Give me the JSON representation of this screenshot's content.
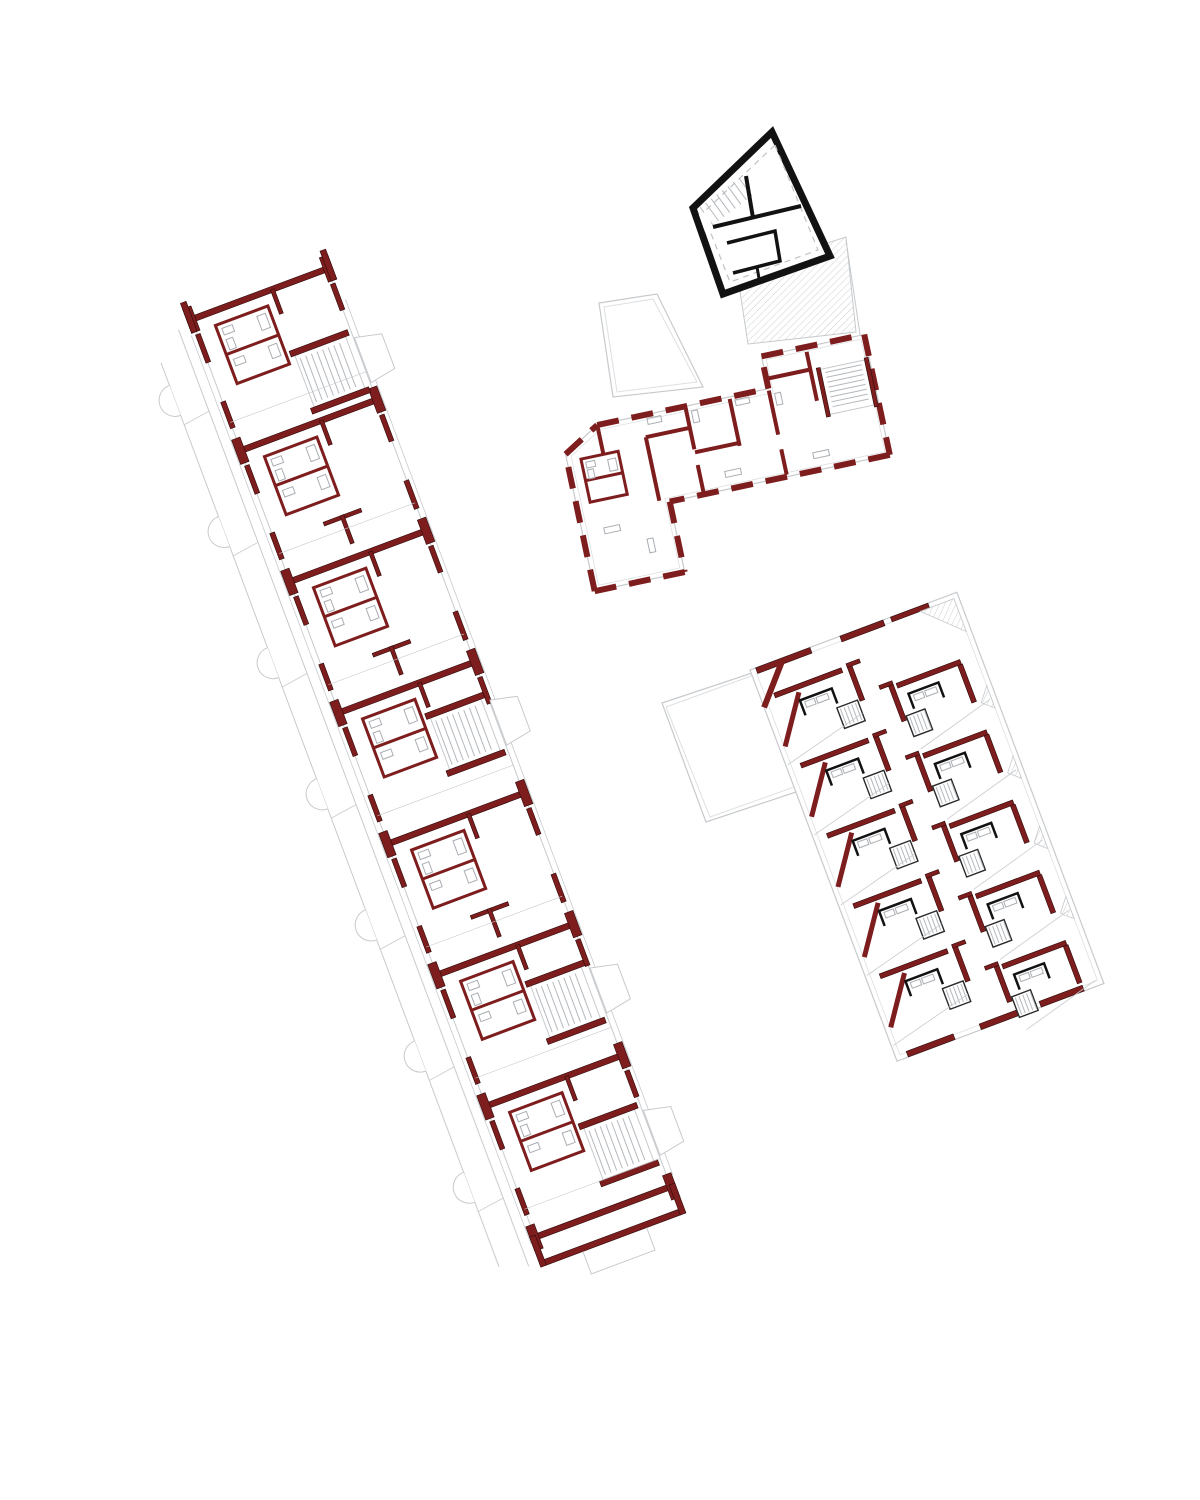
{
  "document": {
    "title": "Apartment buildings floor plan - site drawing",
    "drawing_type": "architectural floor plan, multiple residential buildings",
    "visible_text": ""
  },
  "canvas": {
    "width": 1200,
    "height": 1500,
    "background": "#ffffff"
  },
  "palette": {
    "background": "#ffffff",
    "wall_red": "#7e1d1d",
    "wall_red_edge": "#2f0a0a",
    "wall_black": "#121212",
    "outline_gray": "#c7cacd",
    "outline_gray_light": "#dddfe1",
    "detail_gray": "#a9adb2",
    "stair_gray": "#b4b8bd",
    "dash_gray": "#bfc2c5",
    "hatch_gray": "#cbced1"
  },
  "buildings": [
    {
      "id": "slab-west",
      "label": "linear-apartment-slab",
      "rotation_deg": -20.5,
      "origin": [
        183,
        296
      ],
      "width": 145,
      "length": 1035,
      "module_pitch": 140,
      "modules": 7,
      "party_wall_positions": [
        25,
        165,
        305,
        445,
        585,
        725,
        865,
        1005
      ],
      "stair_positions": [
        95,
        482,
        768,
        920
      ],
      "balcony_count": 7
    },
    {
      "id": "pavilion-north",
      "label": "black-pavilion",
      "rotation_deg": 0,
      "outline": [
        [
          772,
          132
        ],
        [
          830,
          256
        ],
        [
          723,
          294
        ],
        [
          693,
          208
        ]
      ],
      "stairwells": 1
    },
    {
      "id": "l-block-east",
      "label": "l-shaped-block",
      "rotation_deg": -12,
      "origin": [
        620,
        412
      ],
      "perimeter": [
        [
          -62,
          30
        ],
        [
          -25,
          8
        ],
        [
          150,
          8
        ],
        [
          150,
          -25
        ],
        [
          255,
          -25
        ],
        [
          255,
          98
        ],
        [
          30,
          98
        ],
        [
          30,
          170
        ],
        [
          -62,
          170
        ]
      ],
      "perimeter_inset": [
        [
          -57,
          33
        ],
        [
          -23,
          13
        ],
        [
          154,
          13
        ],
        [
          154,
          -21
        ],
        [
          251,
          -21
        ],
        [
          251,
          94
        ],
        [
          26,
          94
        ],
        [
          26,
          165
        ],
        [
          -57,
          165
        ]
      ],
      "stairwells": 1
    },
    {
      "id": "terrace-block-southeast",
      "label": "terraced-block",
      "rotation_deg": -20.6,
      "origin": [
        750,
        670
      ],
      "width": 221,
      "length": 418,
      "rows": 5,
      "row_pitch": 75
    }
  ],
  "site": {
    "courtyards": [
      {
        "id": "courtyard-north",
        "points": [
          [
            599,
            303
          ],
          [
            657,
            294
          ],
          [
            703,
            387
          ],
          [
            613,
            397
          ]
        ],
        "inset": [
          [
            604,
            307
          ],
          [
            653,
            299
          ],
          [
            697,
            382
          ],
          [
            617,
            392
          ]
        ]
      },
      {
        "id": "courtyard-south",
        "points": [
          [
            662,
            703
          ],
          [
            758,
            671
          ],
          [
            802,
            790
          ],
          [
            706,
            822
          ]
        ],
        "inset": [
          [
            666,
            707
          ],
          [
            754,
            675
          ],
          [
            797,
            786
          ],
          [
            710,
            817
          ]
        ]
      }
    ],
    "hatched_terrace": {
      "points": [
        [
          737,
          272
        ],
        [
          846,
          237
        ],
        [
          856,
          332
        ],
        [
          748,
          344
        ]
      ]
    },
    "connector_line": [
      [
        846,
        240
      ],
      [
        861,
        341
      ]
    ]
  }
}
